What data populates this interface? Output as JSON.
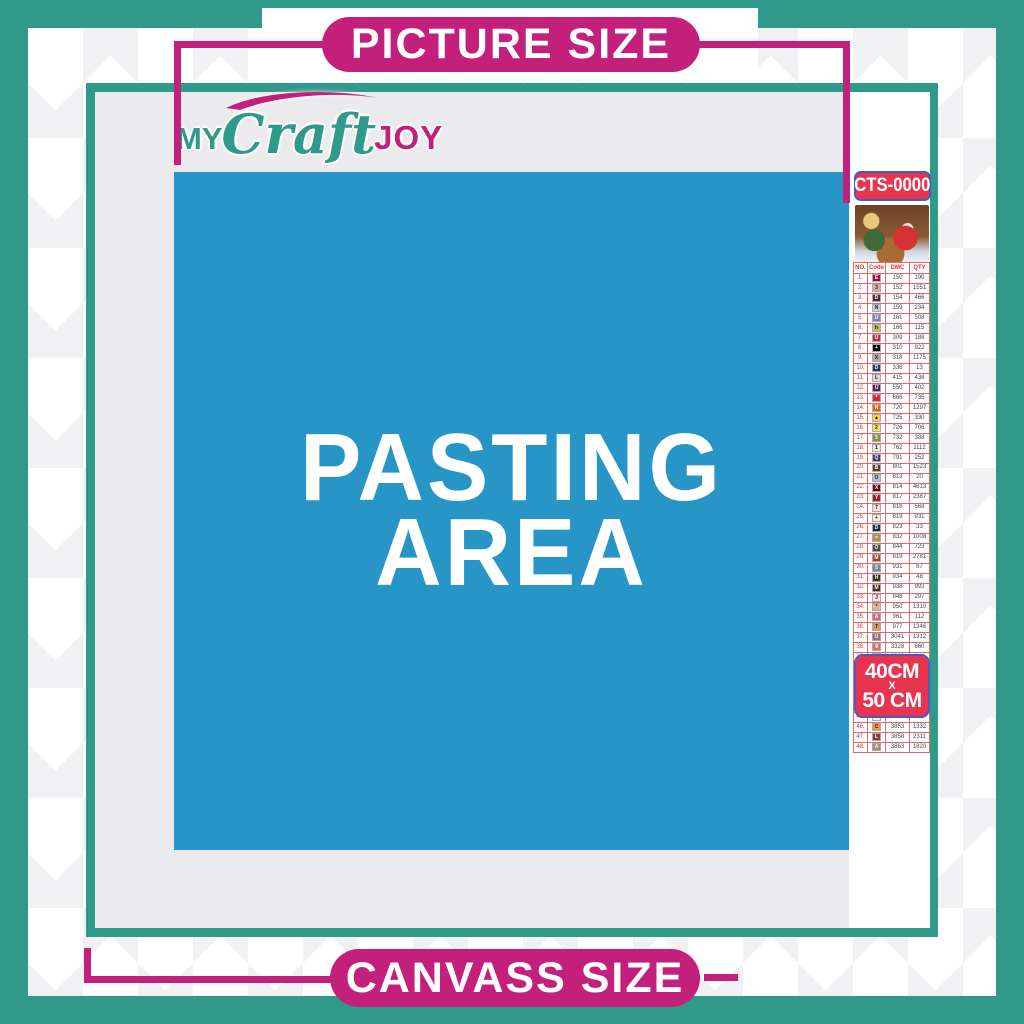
{
  "banners": {
    "top_label": "PICTURE SIZE",
    "bottom_label": "CANVASS SIZE"
  },
  "logo": {
    "word1": "MY",
    "word2": "Craft",
    "word3": "JOY"
  },
  "pasting_area": {
    "line1": "PASTING",
    "line2": "AREA"
  },
  "product": {
    "code": "CTS-0000",
    "thumbnail": "christmas-santa-sleigh-scene",
    "size_line1": "40CM",
    "size_separator": "X",
    "size_line2": "50 CM"
  },
  "legend": {
    "headers": [
      "NO.",
      "Code",
      "DMC",
      "QTY"
    ],
    "rows": [
      [
        "1.",
        "E",
        "#a80c44",
        "#fff",
        "150",
        "190"
      ],
      [
        "2.",
        "3",
        "#dba9a2",
        "#222",
        "152",
        "1551"
      ],
      [
        "3.",
        "D",
        "#53273b",
        "#fff",
        "154",
        "466"
      ],
      [
        "4.",
        "N",
        "#c5cadb",
        "#222",
        "159",
        "234"
      ],
      [
        "5.",
        "U",
        "#7d86ac",
        "#fff",
        "161",
        "508"
      ],
      [
        "6.",
        "h",
        "#bcc04c",
        "#222",
        "166",
        "115"
      ],
      [
        "7.",
        "U",
        "#c42a51",
        "#fff",
        "309",
        "188"
      ],
      [
        "8.",
        "+",
        "#000000",
        "#fff",
        "310",
        "922"
      ],
      [
        "9.",
        "X",
        "#acacac",
        "#222",
        "318",
        "1175"
      ],
      [
        "10.",
        "D",
        "#23355f",
        "#fff",
        "336",
        "13"
      ],
      [
        "11.",
        "L",
        "#d8d8da",
        "#222",
        "415",
        "438"
      ],
      [
        "12.",
        "U",
        "#571c56",
        "#fff",
        "550",
        "402"
      ],
      [
        "13.",
        "*",
        "#e02339",
        "#fff",
        "666",
        "735"
      ],
      [
        "14.",
        "N",
        "#eb6307",
        "#fff",
        "720",
        "1297"
      ],
      [
        "15.",
        "▲",
        "#ffc840",
        "#222",
        "725",
        "330"
      ],
      [
        "16.",
        "2",
        "#ffd96e",
        "#222",
        "726",
        "706"
      ],
      [
        "17.",
        "5",
        "#8f9140",
        "#fff",
        "732",
        "388"
      ],
      [
        "18.",
        "1",
        "#e8e7e9",
        "#222",
        "762",
        "1112"
      ],
      [
        "19.",
        "Q",
        "#343b74",
        "#fff",
        "791",
        "252"
      ],
      [
        "20.",
        "B",
        "#643a23",
        "#fff",
        "801",
        "1523"
      ],
      [
        "21.",
        "O",
        "#a8c6dd",
        "#222",
        "813",
        "20"
      ],
      [
        "22.",
        "X",
        "#760014",
        "#fff",
        "814",
        "4613"
      ],
      [
        "23.",
        "Y",
        "#b8132e",
        "#fff",
        "817",
        "2387"
      ],
      [
        "24.",
        "7",
        "#fadfda",
        "#222",
        "818",
        "568"
      ],
      [
        "25.",
        "+",
        "#f7e6e2",
        "#222",
        "819",
        "931"
      ],
      [
        "26.",
        "D",
        "#1d2a50",
        "#fff",
        "823",
        "33"
      ],
      [
        "27.",
        "=",
        "#b1913c",
        "#fff",
        "832",
        "1008"
      ],
      [
        "28.",
        "O",
        "#4a4a4a",
        "#fff",
        "844",
        "723"
      ],
      [
        "29.",
        "M",
        "#a2461e",
        "#fff",
        "919",
        "2781"
      ],
      [
        "30.",
        "5",
        "#6d8ba3",
        "#fff",
        "931",
        "67"
      ],
      [
        "31.",
        "H",
        "#36391c",
        "#fff",
        "934",
        "48"
      ],
      [
        "32.",
        "M",
        "#42291a",
        "#fff",
        "938",
        "993"
      ],
      [
        "33.",
        "J",
        "#fce7d8",
        "#222",
        "948",
        "297"
      ],
      [
        "34.",
        "*",
        "#e3b294",
        "#222",
        "950",
        "1310"
      ],
      [
        "35.",
        "A",
        "#d16b80",
        "#fff",
        "961",
        "112"
      ],
      [
        "36.",
        "T",
        "#dd9b4e",
        "#222",
        "977",
        "1346"
      ],
      [
        "37.",
        "U",
        "#917084",
        "#fff",
        "3041",
        "1312"
      ],
      [
        "38.",
        "9",
        "#d4706a",
        "#fff",
        "3328",
        "660"
      ],
      [
        "39.",
        "U",
        "#72805f",
        "#fff",
        "3363",
        "144"
      ],
      [
        "40.",
        "B",
        "#2a1503",
        "#fff",
        "3371",
        "1680"
      ],
      [
        "41.",
        "Y",
        "#d8cdd8",
        "#222",
        "3743",
        "1738"
      ],
      [
        "42.",
        "^",
        "#fcefe4",
        "#222",
        "3770",
        "40"
      ],
      [
        "43.",
        "V",
        "#d4bda3",
        "#222",
        "3782",
        "617"
      ],
      [
        "44.",
        "Z",
        "#d8d967",
        "#222",
        "3819",
        "119"
      ],
      [
        "45.",
        "/",
        "#fcf4c3",
        "#222",
        "3823",
        "107"
      ],
      [
        "46.",
        "C",
        "#f0923e",
        "#222",
        "3853",
        "1332"
      ],
      [
        "47.",
        "L",
        "#7c3f35",
        "#fff",
        "3858",
        "2311"
      ],
      [
        "48.",
        "A",
        "#a8886e",
        "#fff",
        "3863",
        "1820"
      ]
    ]
  },
  "colors": {
    "teal": "#2f9a8a",
    "magenta": "#c2207a",
    "red_box": "#e8354f",
    "box_border_blue": "#4a5ac4",
    "pasting_blue": "#2795c5",
    "content_gray": "#ebebed",
    "table_red": "#e03030"
  }
}
